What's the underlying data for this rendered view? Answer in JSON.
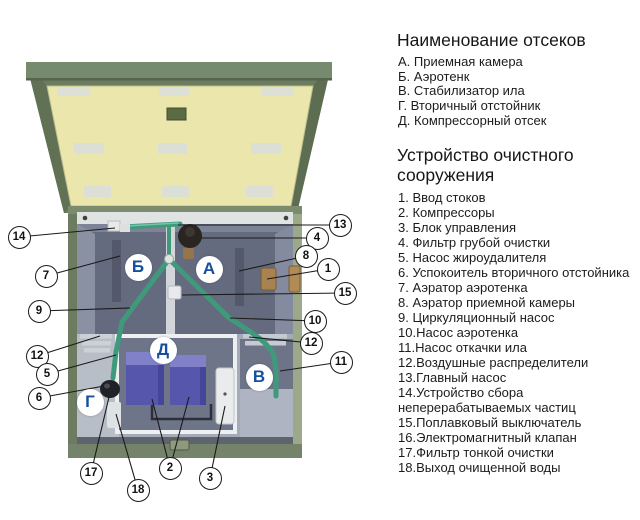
{
  "panels": {
    "compartments": {
      "title": "Наименование отсеков",
      "items": [
        "А. Приемная камера",
        "Б. Аэротенк",
        "В. Стабилизатор ила",
        "Г. Вторичный отстойник",
        "Д. Компрессорный отсек"
      ]
    },
    "device": {
      "title": "Устройство очистного сооружения",
      "items": [
        "1. Ввод стоков",
        "2. Компрессоры",
        "3. Блок управления",
        "4. Фильтр грубой очистки",
        "5. Насос жироудалителя",
        "6. Успокоитель вторичного отстойника",
        "7. Аэратор аэротенка",
        "8. Аэратор приемной камеры",
        "9. Циркуляционный насос",
        "10.Насос аэротенка",
        "11.Насос откачки ила",
        "12.Воздушные распределители",
        "13.Главный насос",
        "14.Устройство сбора неперерабатываемых частиц",
        "15.Поплавковый выключатель",
        "16.Электромагнитный клапан",
        "17.Фильтр тонкой очистки",
        "18.Выход очищенной воды"
      ]
    }
  },
  "diagram": {
    "badges": [
      {
        "letter": "Б",
        "x": 138,
        "y": 267
      },
      {
        "letter": "А",
        "x": 209,
        "y": 269
      },
      {
        "letter": "Д",
        "x": 163,
        "y": 350
      },
      {
        "letter": "В",
        "x": 259,
        "y": 377
      },
      {
        "letter": "Г",
        "x": 90,
        "y": 402
      }
    ],
    "callouts": [
      {
        "n": "14",
        "x": 19,
        "y": 237,
        "targets": [
          [
            115,
            228
          ]
        ]
      },
      {
        "n": "7",
        "x": 46,
        "y": 276,
        "targets": [
          [
            120,
            256
          ]
        ]
      },
      {
        "n": "9",
        "x": 39,
        "y": 311,
        "targets": [
          [
            130,
            308
          ]
        ]
      },
      {
        "n": "12",
        "x": 37,
        "y": 356,
        "targets": [
          [
            100,
            336
          ]
        ]
      },
      {
        "n": "5",
        "x": 47,
        "y": 374,
        "targets": [
          [
            116,
            355
          ]
        ]
      },
      {
        "n": "6",
        "x": 39,
        "y": 398,
        "targets": [
          [
            104,
            386
          ]
        ]
      },
      {
        "n": "13",
        "x": 340,
        "y": 225,
        "targets": [
          [
            178,
            225
          ]
        ]
      },
      {
        "n": "4",
        "x": 317,
        "y": 238,
        "targets": [
          [
            201,
            238
          ]
        ]
      },
      {
        "n": "8",
        "x": 306,
        "y": 256,
        "targets": [
          [
            239,
            271
          ]
        ]
      },
      {
        "n": "1",
        "x": 328,
        "y": 269,
        "targets": [
          [
            267,
            279
          ]
        ]
      },
      {
        "n": "15",
        "x": 345,
        "y": 293,
        "targets": [
          [
            182,
            295
          ]
        ]
      },
      {
        "n": "10",
        "x": 315,
        "y": 321,
        "targets": [
          [
            230,
            318
          ]
        ]
      },
      {
        "n": "12",
        "x": 311,
        "y": 343,
        "targets": [
          [
            249,
            337
          ]
        ]
      },
      {
        "n": "11",
        "x": 341,
        "y": 362,
        "targets": [
          [
            280,
            371
          ]
        ]
      },
      {
        "n": "17",
        "x": 91,
        "y": 473,
        "targets": [
          [
            109,
            397
          ]
        ]
      },
      {
        "n": "18",
        "x": 138,
        "y": 490,
        "targets": [
          [
            116,
            414
          ]
        ]
      },
      {
        "n": "2",
        "x": 170,
        "y": 468,
        "targets": [
          [
            152,
            399
          ],
          [
            189,
            397
          ]
        ]
      },
      {
        "n": "3",
        "x": 210,
        "y": 478,
        "targets": [
          [
            225,
            406
          ]
        ]
      }
    ],
    "colors": {
      "lid_green": "#6c7c60",
      "lid_panel_yellow": "#ebe7ac",
      "tank_olive": "#7c8a6e",
      "wall_slate": "#656b7f",
      "pipe_green": "#3f9a7c",
      "compressor_purple": "#5656ac",
      "inlet_brown": "#a8824f",
      "badge_letter_blue": "#15509e"
    }
  }
}
